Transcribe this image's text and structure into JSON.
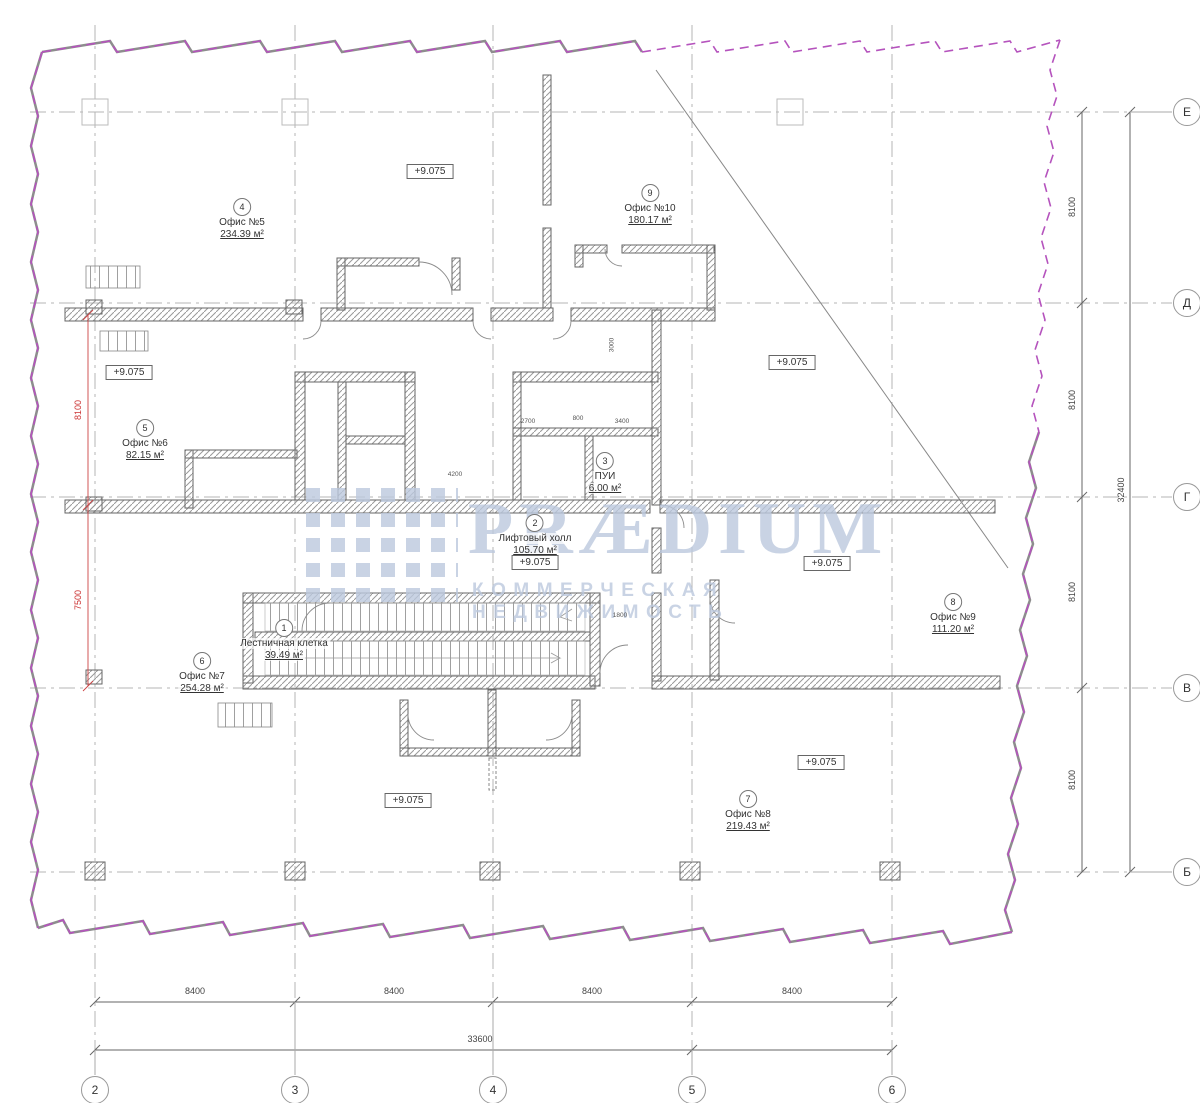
{
  "watermark": {
    "brand": "PRÆDIUM",
    "tagline": "КОММЕРЧЕСКАЯ НЕДВИЖИМОСТЬ",
    "color": "#bcc9de"
  },
  "rooms": [
    {
      "num": "4",
      "name": "Офис №5",
      "area": "234.39 м²"
    },
    {
      "num": "9",
      "name": "Офис №10",
      "area": "180.17 м²"
    },
    {
      "num": "5",
      "name": "Офис №6",
      "area": "82.15 м²"
    },
    {
      "num": "3",
      "name": "ПУИ",
      "area": "6.00 м²"
    },
    {
      "num": "2",
      "name": "Лифтовый холл",
      "area": "105.70 м²"
    },
    {
      "num": "1",
      "name": "Лестничная клетка",
      "area": "39.49 м²"
    },
    {
      "num": "6",
      "name": "Офис №7",
      "area": "254.28 м²"
    },
    {
      "num": "8",
      "name": "Офис №9",
      "area": "111.20 м²"
    },
    {
      "num": "7",
      "name": "Офис №8",
      "area": "219.43 м²"
    }
  ],
  "elevations": {
    "value": "+9.075"
  },
  "grid": {
    "columns": [
      "2",
      "3",
      "4",
      "5",
      "6"
    ],
    "rows": [
      "Е",
      "Д",
      "Г",
      "В",
      "Б"
    ]
  },
  "dimensions": {
    "bottom_segments": [
      "8400",
      "8400",
      "8400",
      "8400"
    ],
    "bottom_total": "33600",
    "right_segments": [
      "8100",
      "8100",
      "8100",
      "8100"
    ],
    "right_total": "32400",
    "left_red": [
      "8100",
      "7500"
    ],
    "detail": [
      "2700",
      "800",
      "3400",
      "4200",
      "1800",
      "3000"
    ]
  },
  "colors": {
    "boundary": "#b553bd",
    "wall_hatch": "#999999",
    "red_dim": "#cc3333"
  }
}
